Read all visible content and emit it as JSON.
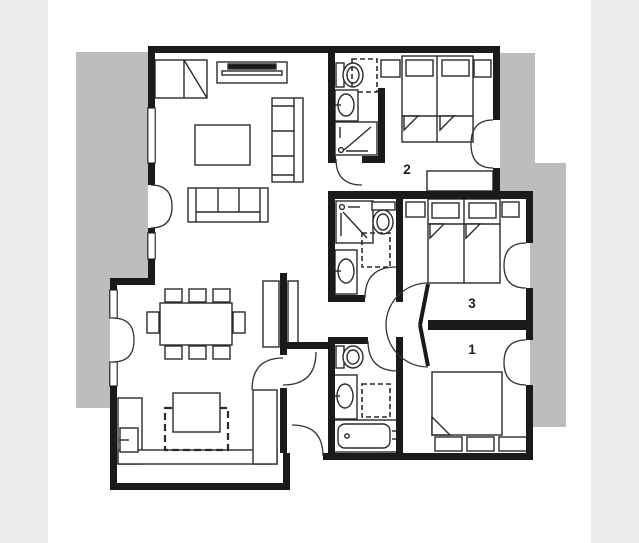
{
  "page": {
    "type": "apartment floor plan drawing",
    "background": "#ffffff"
  },
  "colors": {
    "wall": "#1a1a1a",
    "floor": "#ffffff",
    "furniture_line": "#2b2b2b",
    "exterior_shadow": "#bdbdbf",
    "page_margin_strip": "#ececed",
    "label_text": "#1d1d1d"
  },
  "floor_plan": {
    "rooms": [
      {
        "id": "bedroom-1",
        "label": "1",
        "features": [
          "double-bed",
          "storage-boxes",
          "french-door"
        ]
      },
      {
        "id": "bedroom-2",
        "label": "2",
        "features": [
          "twin-bed",
          "nightstands",
          "wardrobe",
          "closet-dashed",
          "french-door"
        ]
      },
      {
        "id": "bedroom-3",
        "label": "3",
        "features": [
          "twin-bed",
          "nightstands",
          "french-door"
        ]
      }
    ],
    "unlabeled_areas": [
      {
        "id": "living-room",
        "features": [
          "corner-cabinet",
          "tv-console",
          "sofa-vertical",
          "sofa-horizontal",
          "coffee-table"
        ]
      },
      {
        "id": "dining-area",
        "features": [
          "dining-table",
          "eight-chairs"
        ]
      },
      {
        "id": "kitchen",
        "features": [
          "u-counter",
          "island",
          "island-dashed-outline",
          "appliance"
        ]
      },
      {
        "id": "bathroom-top",
        "features": [
          "toilet",
          "sink",
          "shower",
          "closet-dashed"
        ]
      },
      {
        "id": "bathroom-middle",
        "features": [
          "shower",
          "toilet",
          "sink",
          "closet-dashed"
        ]
      },
      {
        "id": "bathroom-bottom",
        "features": [
          "toilet",
          "sink",
          "bathtub",
          "closet-dashed"
        ]
      },
      {
        "id": "hallway",
        "features": [
          "double-swing-doors"
        ]
      },
      {
        "id": "mudroom",
        "features": [
          "back-door"
        ]
      }
    ]
  }
}
